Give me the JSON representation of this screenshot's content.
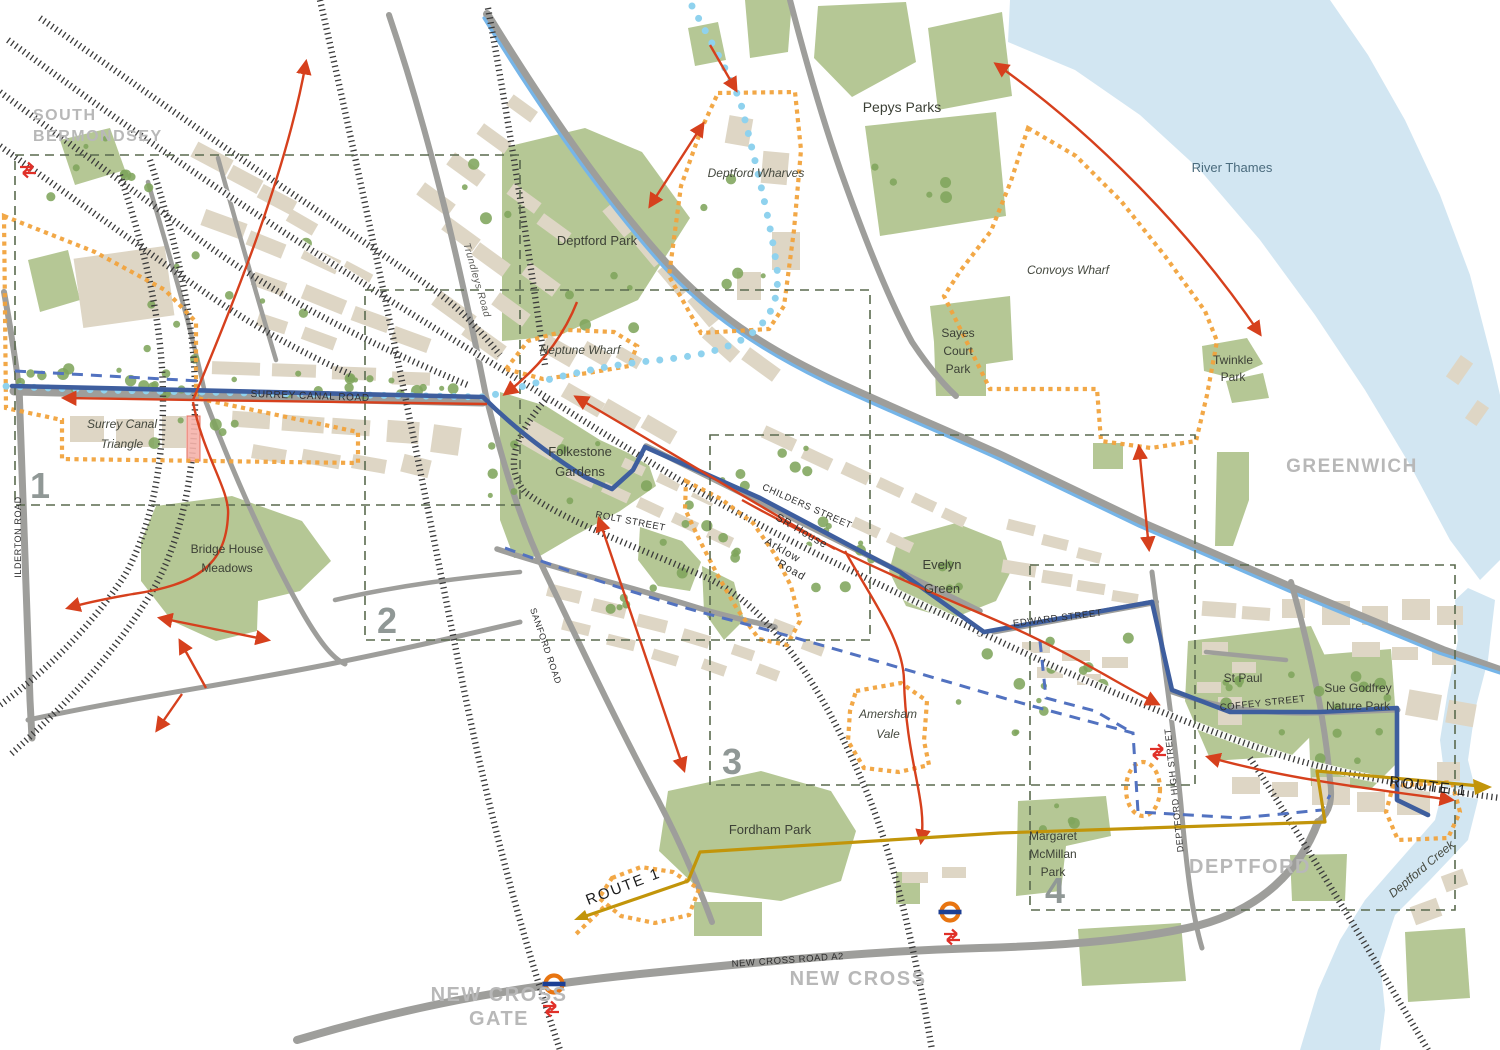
{
  "map": {
    "colors": {
      "water": "#d2e6f2",
      "park": "#b5c795",
      "tree": "#7fa55c",
      "bld": "#ded6c5",
      "road": "#9e9e9b",
      "railc": "#3a3a3a",
      "navy": "#3e5e9e",
      "dnavy": "#5272c0",
      "lblue": "#76b5e8",
      "cyan": "#8fd2ee",
      "orange": "#f1a33d",
      "red": "#d6401d",
      "gold": "#c2950a",
      "boxc": "#5a6a4e",
      "numc": "#909896",
      "district": "#b8b8b8"
    },
    "labels": [
      {
        "id": "south-bermondsey-1",
        "text": "SOUTH",
        "x": 33,
        "y": 120,
        "s": 16,
        "cls": "lbl-district",
        "anchor": "start"
      },
      {
        "id": "south-bermondsey-2",
        "text": "BERMONDSEY",
        "x": 33,
        "y": 141,
        "s": 16,
        "cls": "lbl-district",
        "anchor": "start"
      },
      {
        "id": "greenwich",
        "text": "GREENWICH",
        "x": 1352,
        "y": 472,
        "s": 19,
        "cls": "lbl-district"
      },
      {
        "id": "deptford",
        "text": "DEPTFORD",
        "x": 1250,
        "y": 873,
        "s": 20,
        "cls": "lbl-district"
      },
      {
        "id": "new-cross",
        "text": "NEW CROSS",
        "x": 858,
        "y": 985,
        "s": 20,
        "cls": "lbl-district"
      },
      {
        "id": "new-cross-gate-1",
        "text": "NEW CROSS",
        "x": 499,
        "y": 1001,
        "s": 20,
        "cls": "lbl-district"
      },
      {
        "id": "new-cross-gate-2",
        "text": "GATE",
        "x": 499,
        "y": 1025,
        "s": 20,
        "cls": "lbl-district"
      },
      {
        "id": "pepys-parks",
        "text": "Pepys Parks",
        "x": 902,
        "y": 112,
        "s": 14,
        "cls": "lbl-place"
      },
      {
        "id": "deptford-park",
        "text": "Deptford Park",
        "x": 597,
        "y": 245,
        "s": 13,
        "cls": "lbl-place"
      },
      {
        "id": "sayes-court-1",
        "text": "Sayes",
        "x": 958,
        "y": 337,
        "s": 12,
        "cls": "lbl-place"
      },
      {
        "id": "sayes-court-2",
        "text": "Court",
        "x": 958,
        "y": 355,
        "s": 12,
        "cls": "lbl-place"
      },
      {
        "id": "sayes-court-3",
        "text": "Park",
        "x": 958,
        "y": 373,
        "s": 12,
        "cls": "lbl-place"
      },
      {
        "id": "twinkle-1",
        "text": "Twinkle",
        "x": 1233,
        "y": 364,
        "s": 12,
        "cls": "lbl-place"
      },
      {
        "id": "twinkle-2",
        "text": "Park",
        "x": 1233,
        "y": 381,
        "s": 12,
        "cls": "lbl-place"
      },
      {
        "id": "folkestone-1",
        "text": "Folkestone",
        "x": 580,
        "y": 456,
        "s": 13,
        "cls": "lbl-place"
      },
      {
        "id": "folkestone-2",
        "text": "Gardens",
        "x": 580,
        "y": 476,
        "s": 13,
        "cls": "lbl-place"
      },
      {
        "id": "bridge-house-1",
        "text": "Bridge House",
        "x": 227,
        "y": 553,
        "s": 12,
        "cls": "lbl-place"
      },
      {
        "id": "bridge-house-2",
        "text": "Meadows",
        "x": 227,
        "y": 572,
        "s": 12,
        "cls": "lbl-place"
      },
      {
        "id": "evelyn-green-1",
        "text": "Evelyn",
        "x": 942,
        "y": 569,
        "s": 13,
        "cls": "lbl-place"
      },
      {
        "id": "evelyn-green-2",
        "text": "Green",
        "x": 942,
        "y": 593,
        "s": 13,
        "cls": "lbl-place"
      },
      {
        "id": "st-paul",
        "text": "St Paul",
        "x": 1243,
        "y": 682,
        "s": 12,
        "cls": "lbl-place"
      },
      {
        "id": "sue-godfrey-1",
        "text": "Sue Godfrey",
        "x": 1358,
        "y": 692,
        "s": 12,
        "cls": "lbl-place"
      },
      {
        "id": "sue-godfrey-2",
        "text": "Nature Park",
        "x": 1358,
        "y": 710,
        "s": 12,
        "cls": "lbl-place"
      },
      {
        "id": "fordham-park",
        "text": "Fordham Park",
        "x": 770,
        "y": 834,
        "s": 13,
        "cls": "lbl-place"
      },
      {
        "id": "mcmillan-1",
        "text": "Margaret",
        "x": 1053,
        "y": 840,
        "s": 12,
        "cls": "lbl-place"
      },
      {
        "id": "mcmillan-2",
        "text": "McMillan",
        "x": 1053,
        "y": 858,
        "s": 12,
        "cls": "lbl-place"
      },
      {
        "id": "mcmillan-3",
        "text": "Park",
        "x": 1053,
        "y": 876,
        "s": 12,
        "cls": "lbl-place"
      },
      {
        "id": "river-thames",
        "text": "River Thames",
        "x": 1232,
        "y": 172,
        "s": 13,
        "cls": "lbl-water"
      },
      {
        "id": "surrey-canal-triangle-1",
        "text": "Surrey Canal",
        "x": 122,
        "y": 428,
        "s": 12,
        "cls": "lbl-site"
      },
      {
        "id": "surrey-canal-triangle-2",
        "text": "Triangle",
        "x": 122,
        "y": 448,
        "s": 12,
        "cls": "lbl-site"
      },
      {
        "id": "deptford-wharves",
        "text": "Deptford Wharves",
        "x": 756,
        "y": 177,
        "s": 12,
        "cls": "lbl-site"
      },
      {
        "id": "convoys-wharf",
        "text": "Convoys Wharf",
        "x": 1068,
        "y": 274,
        "s": 12,
        "cls": "lbl-site"
      },
      {
        "id": "neptune-wharf",
        "text": "Neptune Wharf",
        "x": 580,
        "y": 354,
        "s": 12,
        "cls": "lbl-site"
      },
      {
        "id": "amersham-vale-1",
        "text": "Amersham",
        "x": 888,
        "y": 718,
        "s": 12,
        "cls": "lbl-site"
      },
      {
        "id": "amersham-vale-2",
        "text": "Vale",
        "x": 888,
        "y": 738,
        "s": 12,
        "cls": "lbl-site"
      },
      {
        "id": "deptford-creek",
        "text": "Deptford Creek",
        "x": 1424,
        "y": 872,
        "s": 12,
        "cls": "lbl-site",
        "rot": -40
      },
      {
        "id": "surrey-canal-road",
        "text": "SURREY CANAL ROAD",
        "x": 310,
        "y": 399,
        "s": 10,
        "cls": "lbl-street",
        "rot": 2
      },
      {
        "id": "childers-street",
        "text": "CHILDERS STREET",
        "x": 806,
        "y": 509,
        "s": 9.5,
        "cls": "lbl-street",
        "rot": 24
      },
      {
        "id": "rolt-street",
        "text": "ROLT STREET",
        "x": 630,
        "y": 524,
        "s": 9.5,
        "cls": "lbl-street",
        "rot": 11
      },
      {
        "id": "edward-street",
        "text": "EDWARD STREET",
        "x": 1058,
        "y": 621,
        "s": 9.5,
        "cls": "lbl-street",
        "rot": -7
      },
      {
        "id": "coffey-street",
        "text": "COFFEY STREET",
        "x": 1263,
        "y": 706,
        "s": 9.5,
        "cls": "lbl-street",
        "rot": -6
      },
      {
        "id": "new-cross-road-a2",
        "text": "NEW CROSS ROAD A2",
        "x": 788,
        "y": 963,
        "s": 9.5,
        "cls": "lbl-street",
        "rot": -4
      },
      {
        "id": "ilderton-road",
        "text": "ILDERTON ROAD",
        "x": 21,
        "y": 537,
        "s": 9,
        "cls": "lbl-street",
        "rot": -90
      },
      {
        "id": "deptford-high-street",
        "text": "DEPTFORD HIGH STREET",
        "x": 1177,
        "y": 790,
        "s": 9,
        "cls": "lbl-street",
        "rot": -96
      },
      {
        "id": "sanford-road",
        "text": "SANFORD ROAD",
        "x": 543,
        "y": 647,
        "s": 9,
        "cls": "lbl-street",
        "rot": 71
      },
      {
        "id": "sr-house",
        "text": "SR House",
        "x": 800,
        "y": 534,
        "s": 11,
        "cls": "lbl-street-m",
        "rot": 30
      },
      {
        "id": "arklow-road-1",
        "text": "Arklow",
        "x": 781,
        "y": 553,
        "s": 11,
        "cls": "lbl-street-m",
        "rot": 30
      },
      {
        "id": "arklow-road-2",
        "text": "Road",
        "x": 790,
        "y": 573,
        "s": 11,
        "cls": "lbl-street-m",
        "rot": 30
      },
      {
        "id": "trundleys-road",
        "text": "Trundleys Road",
        "x": 474,
        "y": 281,
        "s": 10,
        "cls": "lbl-street-i",
        "rot": 74
      },
      {
        "id": "route-1-west",
        "text": "ROUTE 1",
        "x": 625,
        "y": 891,
        "s": 15,
        "cls": "lbl-route",
        "rot": -21
      },
      {
        "id": "route-1-east",
        "text": "ROUTE 1",
        "x": 1428,
        "y": 791,
        "s": 15,
        "cls": "lbl-route",
        "rot": 7
      }
    ],
    "areas": [
      {
        "number": "1",
        "box": [
          15,
          155,
          505,
          350
        ],
        "nx": 30,
        "ny": 498
      },
      {
        "number": "2",
        "box": [
          365,
          290,
          505,
          350
        ],
        "nx": 377,
        "ny": 633
      },
      {
        "number": "3",
        "box": [
          710,
          435,
          485,
          350
        ],
        "nx": 722,
        "ny": 774
      },
      {
        "number": "4",
        "box": [
          1030,
          565,
          425,
          345
        ],
        "nx": 1045,
        "ny": 903
      }
    ],
    "stations": [
      {
        "type": "national-rail",
        "x": 28,
        "y": 170
      },
      {
        "type": "national-rail",
        "x": 1158,
        "y": 752
      },
      {
        "type": "overground",
        "x": 950,
        "y": 912
      },
      {
        "type": "national-rail",
        "x": 952,
        "y": 937
      },
      {
        "type": "overground",
        "x": 554,
        "y": 984
      },
      {
        "type": "national-rail",
        "x": 551,
        "y": 1009
      }
    ]
  }
}
